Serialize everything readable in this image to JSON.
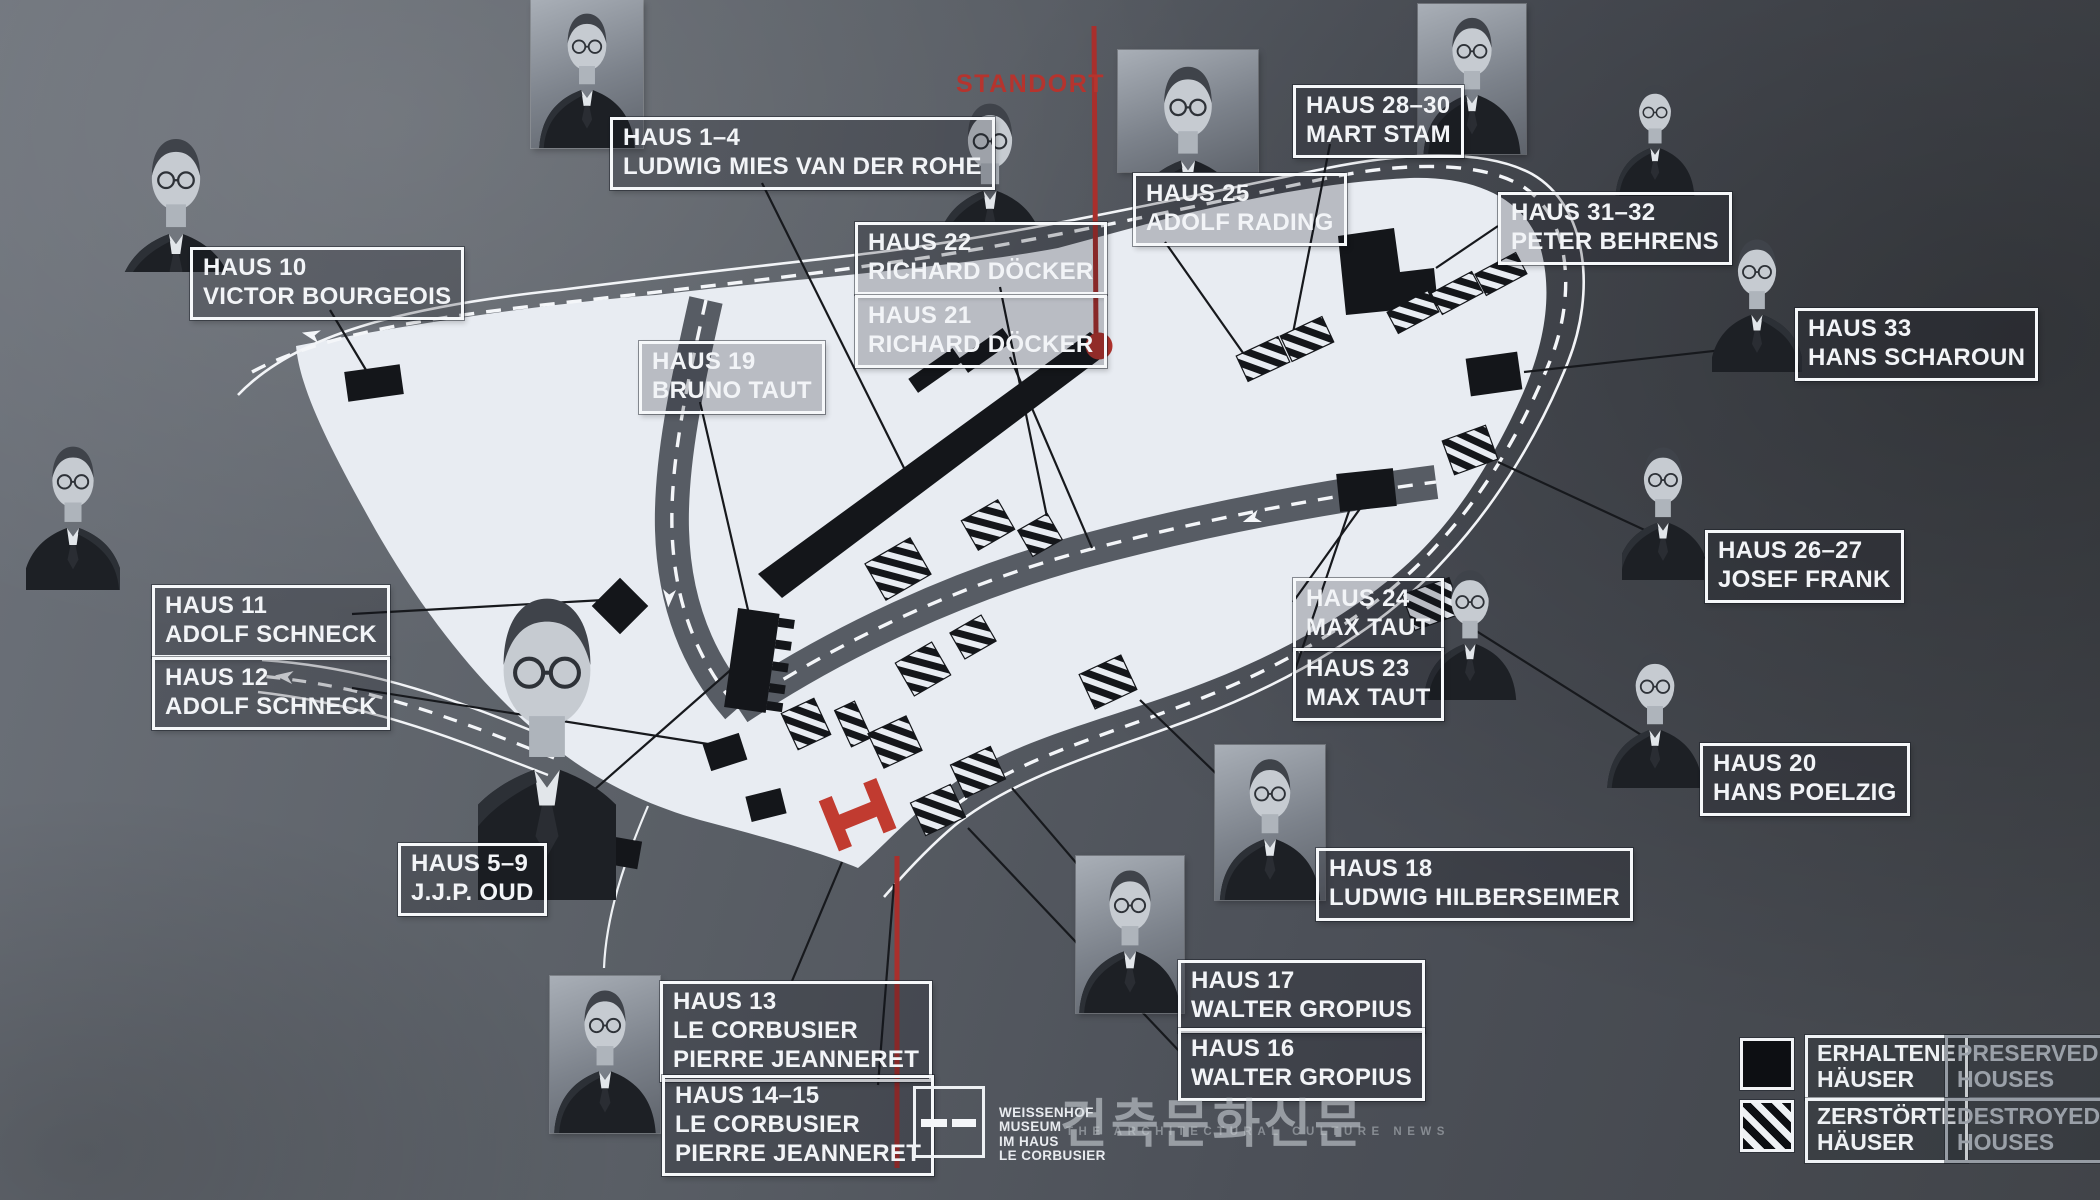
{
  "standort": {
    "label": "STANDORT"
  },
  "labels": {
    "haus_1_4": {
      "text": "HAUS 1–4\nLUDWIG MIES VAN DER ROHE"
    },
    "haus_10": {
      "text": "HAUS 10\nVICTOR BOURGEOIS"
    },
    "haus_19": {
      "text": "HAUS 19\nBRUNO TAUT"
    },
    "haus_22": {
      "text": "HAUS 22\nRICHARD DÖCKER"
    },
    "haus_21": {
      "text": "HAUS 21\nRICHARD DÖCKER"
    },
    "haus_25": {
      "text": "HAUS 25\nADOLF RADING"
    },
    "haus_28_30": {
      "text": "HAUS 28–30\nMART STAM"
    },
    "haus_31_32": {
      "text": "HAUS 31–32\nPETER BEHRENS"
    },
    "haus_33": {
      "text": "HAUS 33\nHANS SCHAROUN"
    },
    "haus_26_27": {
      "text": "HAUS 26–27\nJOSEF FRANK"
    },
    "haus_24": {
      "text": "HAUS 24\nMAX TAUT"
    },
    "haus_23": {
      "text": "HAUS 23\nMAX TAUT"
    },
    "haus_11": {
      "text": "HAUS 11\nADOLF SCHNECK"
    },
    "haus_12": {
      "text": "HAUS 12\nADOLF SCHNECK"
    },
    "haus_20": {
      "text": "HAUS 20\nHANS POELZIG"
    },
    "haus_18": {
      "text": "HAUS 18\nLUDWIG HILBERSEIMER"
    },
    "haus_17": {
      "text": "HAUS 17\nWALTER GROPIUS"
    },
    "haus_16": {
      "text": "HAUS 16\nWALTER GROPIUS"
    },
    "haus_5_9": {
      "text": "HAUS 5–9\nJ.J.P. OUD"
    },
    "haus_13": {
      "text": "HAUS 13\nLE CORBUSIER\nPIERRE JEANNERET"
    },
    "haus_14_15": {
      "text": "HAUS 14–15\nLE CORBUSIER\nPIERRE JEANNERET"
    }
  },
  "legend": {
    "erhaltene": {
      "de": "ERHALTENE\nHÄUSER",
      "en": "PRESERVED\nHOUSES"
    },
    "zerstoerte": {
      "de": "ZERSTÖRTE\nHÄUSER",
      "en": "DESTROYED\nHOUSES"
    }
  },
  "museum_logo": {
    "text": "WEISSENHOF\nMUSEUM\nIM HAUS\nLE CORBUSIER"
  },
  "watermark": {
    "korean": "건축문화신문",
    "english": "THE ARCHITECTURAL CULTURE NEWS"
  },
  "colors": {
    "accent_red": "#b5342e",
    "map_white": "#e8ecf2",
    "building_black": "#15171b",
    "background_gray": "#565b62"
  },
  "icons": {
    "portraits": [
      "portrait-ludwig-mies-van-der-rohe",
      "portrait-victor-bourgeois",
      "portrait-richard-doecker",
      "portrait-adolf-rading",
      "portrait-mart-stam",
      "portrait-peter-behrens",
      "portrait-hans-scharoun",
      "portrait-josef-frank",
      "portrait-max-taut",
      "portrait-hans-poelzig",
      "portrait-adolf-schneck",
      "portrait-jjp-oud",
      "portrait-ludwig-hilberseimer",
      "portrait-walter-gropius",
      "portrait-le-corbusier"
    ],
    "legend_swatches": [
      "preserved-swatch-icon",
      "destroyed-swatch-icon"
    ],
    "museum_logo_icon": "weissenhof-museum-facade-icon"
  }
}
